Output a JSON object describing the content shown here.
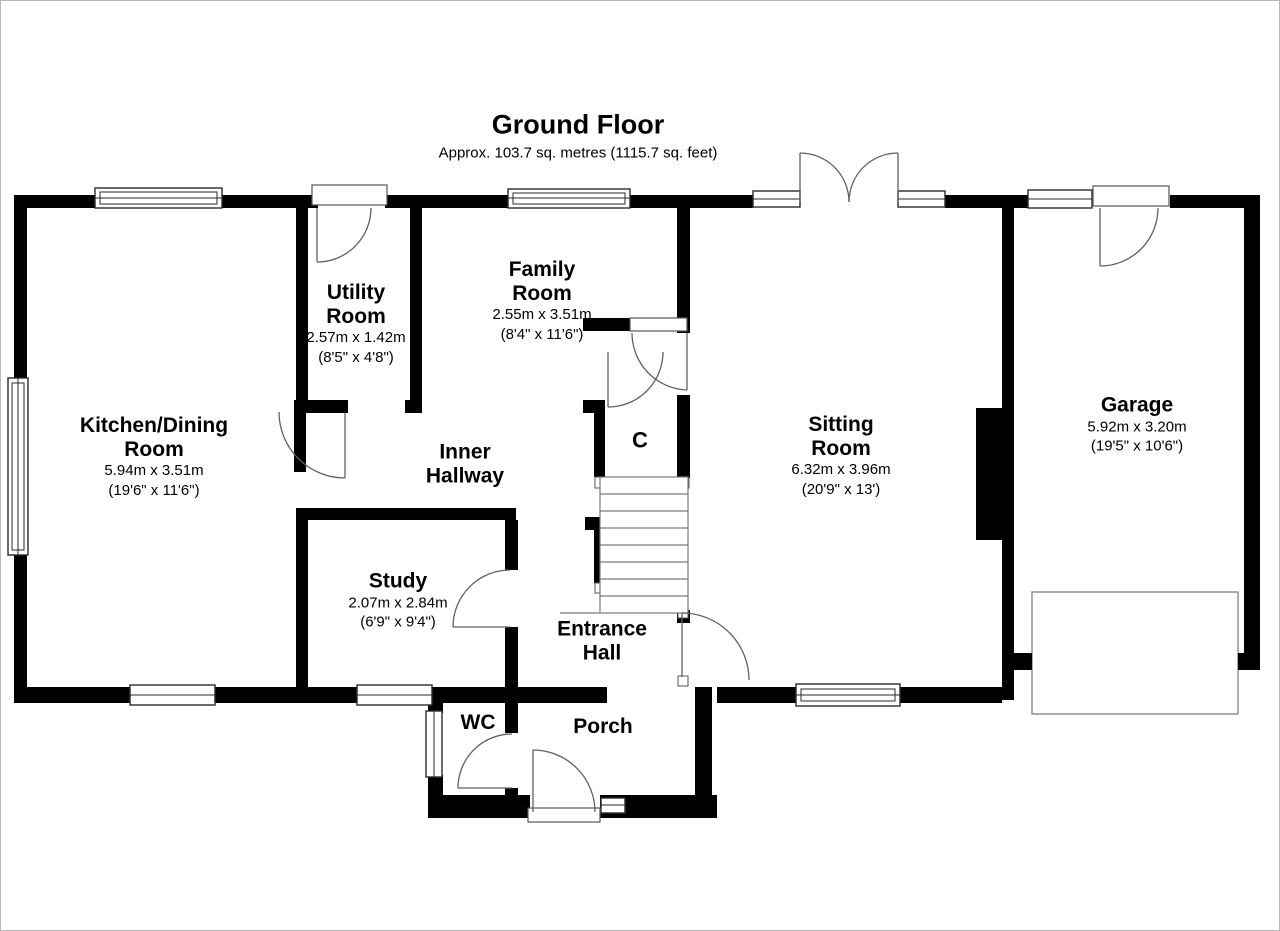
{
  "title": {
    "heading": "Ground Floor",
    "subtitle": "Approx. 103.7 sq. metres (1115.7 sq. feet)"
  },
  "rooms": {
    "kitchen": {
      "name": "Kitchen/Dining Room",
      "metric": "5.94m x 3.51m",
      "imperial": "(19'6\" x 11'6\")"
    },
    "utility": {
      "name": "Utility Room",
      "metric": "2.57m x 1.42m",
      "imperial": "(8'5\" x 4'8\")"
    },
    "family": {
      "name": "Family Room",
      "metric": "2.55m x 3.51m",
      "imperial": "(8'4\" x 11'6\")"
    },
    "sitting": {
      "name": "Sitting Room",
      "metric": "6.32m x 3.96m",
      "imperial": "(20'9\" x 13')"
    },
    "garage": {
      "name": "Garage",
      "metric": "5.92m x 3.20m",
      "imperial": "(19'5\" x 10'6\")"
    },
    "study": {
      "name": "Study",
      "metric": "2.07m x 2.84m",
      "imperial": "(6'9\" x 9'4\")"
    },
    "inner_hallway": {
      "name": "Inner Hallway"
    },
    "entrance_hall": {
      "name": "Entrance Hall"
    },
    "cupboard": {
      "name": "C"
    },
    "wc": {
      "name": "WC"
    },
    "porch": {
      "name": "Porch"
    }
  },
  "colors": {
    "wall": "#000000",
    "door_line": "#606060",
    "background": "#ffffff"
  }
}
